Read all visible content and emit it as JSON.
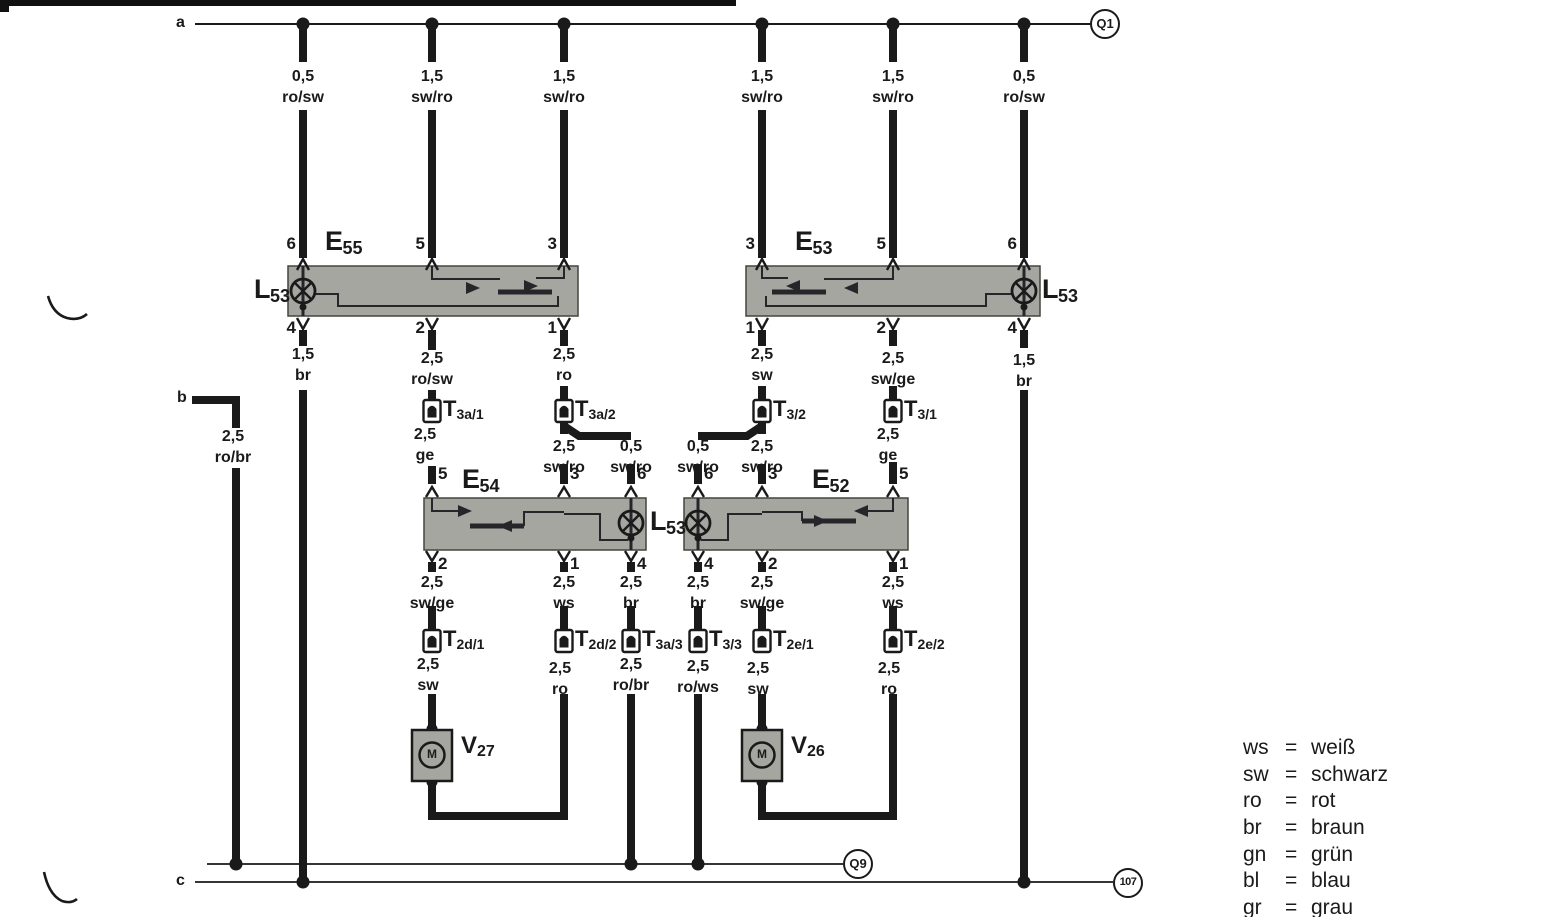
{
  "rails": {
    "a_label": "a",
    "b_label": "b",
    "c_label": "c"
  },
  "terminals": {
    "q1": "Q1",
    "q9": "Q9",
    "ground_107": "107"
  },
  "components": {
    "e55": {
      "prefix": "E",
      "sub": "55"
    },
    "e53": {
      "prefix": "E",
      "sub": "53"
    },
    "e54": {
      "prefix": "E",
      "sub": "54"
    },
    "e52": {
      "prefix": "E",
      "sub": "52"
    },
    "l53_left": {
      "prefix": "L",
      "sub": "53"
    },
    "l53_right": {
      "prefix": "L",
      "sub": "53"
    },
    "l53_mid": {
      "prefix": "L",
      "sub": "53"
    },
    "v27": {
      "prefix": "V",
      "sub": "27"
    },
    "v26": {
      "prefix": "V",
      "sub": "26"
    },
    "motor_letter": "M"
  },
  "connectors": {
    "t3a_1": {
      "prefix": "T",
      "sub": "3a/1"
    },
    "t3a_2": {
      "prefix": "T",
      "sub": "3a/2"
    },
    "t3_2": {
      "prefix": "T",
      "sub": "3/2"
    },
    "t3_1": {
      "prefix": "T",
      "sub": "3/1"
    },
    "t2d_1": {
      "prefix": "T",
      "sub": "2d/1"
    },
    "t2d_2": {
      "prefix": "T",
      "sub": "2d/2"
    },
    "t3a_3": {
      "prefix": "T",
      "sub": "3a/3"
    },
    "t3_3": {
      "prefix": "T",
      "sub": "3/3"
    },
    "t2e_1": {
      "prefix": "T",
      "sub": "2e/1"
    },
    "t2e_2": {
      "prefix": "T",
      "sub": "2e/2"
    }
  },
  "pins": {
    "e55_top": [
      "6",
      "5",
      "3"
    ],
    "e55_bottom": [
      "4",
      "2",
      "1"
    ],
    "e53_top": [
      "3",
      "5",
      "6"
    ],
    "e53_bottom": [
      "1",
      "2",
      "4"
    ],
    "e54_top": [
      "5",
      "3",
      "6"
    ],
    "e54_bottom": [
      "2",
      "1",
      "4"
    ],
    "e52_top": [
      "6",
      "3",
      "5"
    ],
    "e52_bottom": [
      "4",
      "2",
      "1"
    ]
  },
  "wires": {
    "top_1": {
      "gauge": "0,5",
      "color": "ro/sw"
    },
    "top_2": {
      "gauge": "1,5",
      "color": "sw/ro"
    },
    "top_3": {
      "gauge": "1,5",
      "color": "sw/ro"
    },
    "top_4": {
      "gauge": "1,5",
      "color": "sw/ro"
    },
    "top_5": {
      "gauge": "1,5",
      "color": "sw/ro"
    },
    "top_6": {
      "gauge": "0,5",
      "color": "ro/sw"
    },
    "e55_pin4": {
      "gauge": "1,5",
      "color": "br"
    },
    "e55_pin2": {
      "gauge": "2,5",
      "color": "ro/sw"
    },
    "e55_pin1": {
      "gauge": "2,5",
      "color": "ro"
    },
    "e53_pin1": {
      "gauge": "2,5",
      "color": "sw"
    },
    "e53_pin2": {
      "gauge": "2,5",
      "color": "sw/ge"
    },
    "e53_pin4": {
      "gauge": "1,5",
      "color": "br"
    },
    "t3a1_out": {
      "gauge": "2,5",
      "color": "ge"
    },
    "t3a2_main": {
      "gauge": "2,5",
      "color": "sw/ro"
    },
    "t3a2_branch": {
      "gauge": "0,5",
      "color": "sw/ro"
    },
    "t32_branch": {
      "gauge": "0,5",
      "color": "sw/ro"
    },
    "t32_main": {
      "gauge": "2,5",
      "color": "sw/ro"
    },
    "t31_out": {
      "gauge": "2,5",
      "color": "ge"
    },
    "e54_pin2": {
      "gauge": "2,5",
      "color": "sw/ge"
    },
    "e54_pin1": {
      "gauge": "2,5",
      "color": "ws"
    },
    "e54_pin4": {
      "gauge": "2,5",
      "color": "br"
    },
    "e52_pin4": {
      "gauge": "2,5",
      "color": "br"
    },
    "e52_pin2": {
      "gauge": "2,5",
      "color": "sw/ge"
    },
    "e52_pin1": {
      "gauge": "2,5",
      "color": "ws"
    },
    "t2d1_out": {
      "gauge": "2,5",
      "color": "sw"
    },
    "t2d2_out": {
      "gauge": "2,5",
      "color": "ro"
    },
    "t3a3_out": {
      "gauge": "2,5",
      "color": "ro/br"
    },
    "t33_out": {
      "gauge": "2,5",
      "color": "ro/ws"
    },
    "t2e1_out": {
      "gauge": "2,5",
      "color": "sw"
    },
    "t2e2_out": {
      "gauge": "2,5",
      "color": "ro"
    },
    "b_feed": {
      "gauge": "2,5",
      "color": "ro/br"
    }
  },
  "legend": {
    "eq": "=",
    "rows": [
      {
        "abbr": "ws",
        "name": "weiß"
      },
      {
        "abbr": "sw",
        "name": "schwarz"
      },
      {
        "abbr": "ro",
        "name": "rot"
      },
      {
        "abbr": "br",
        "name": "braun"
      },
      {
        "abbr": "gn",
        "name": "grün"
      },
      {
        "abbr": "bl",
        "name": "blau"
      },
      {
        "abbr": "gr",
        "name": "grau"
      }
    ]
  },
  "ink_color": "#1a1a1a",
  "box_fill": "#a6a6a1"
}
